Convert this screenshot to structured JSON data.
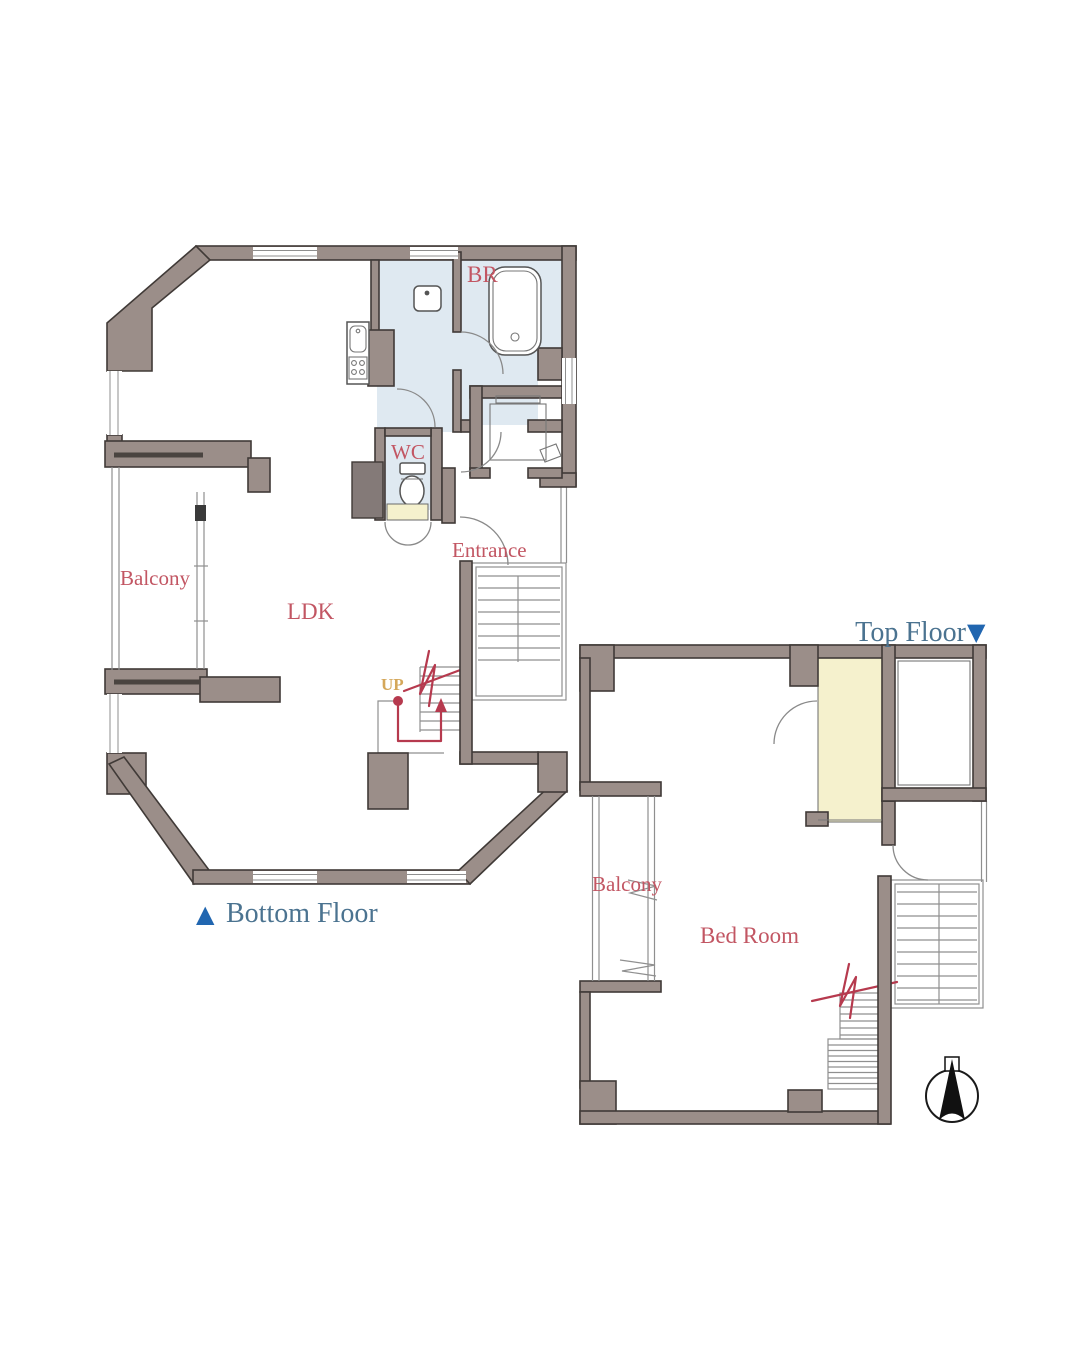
{
  "colors": {
    "wall_fill": "#9b8e89",
    "wall_stroke": "#403a37",
    "wet_blue": "#dfe9f1",
    "cream": "#f5f1cd",
    "label_rose": "#c25663",
    "label_steel": "#4b7390",
    "marker_blue": "#2166b0",
    "route_red": "#b63a4e",
    "up_gold": "#d4a75a",
    "line_gray": "#8f8f8f",
    "fixture_line": "#555555",
    "dark_block": "#847a78"
  },
  "bottom_floor": {
    "marker": "▲",
    "caption": "Bottom Floor",
    "rooms": {
      "balcony": "Balcony",
      "ldk": "LDK",
      "wc": "WC",
      "br": "BR",
      "entrance": "Entrance",
      "up": "UP"
    }
  },
  "top_floor": {
    "marker": "▼",
    "caption": "Top Floor",
    "rooms": {
      "balcony": "Balcony",
      "bedroom": "Bed Room"
    }
  }
}
